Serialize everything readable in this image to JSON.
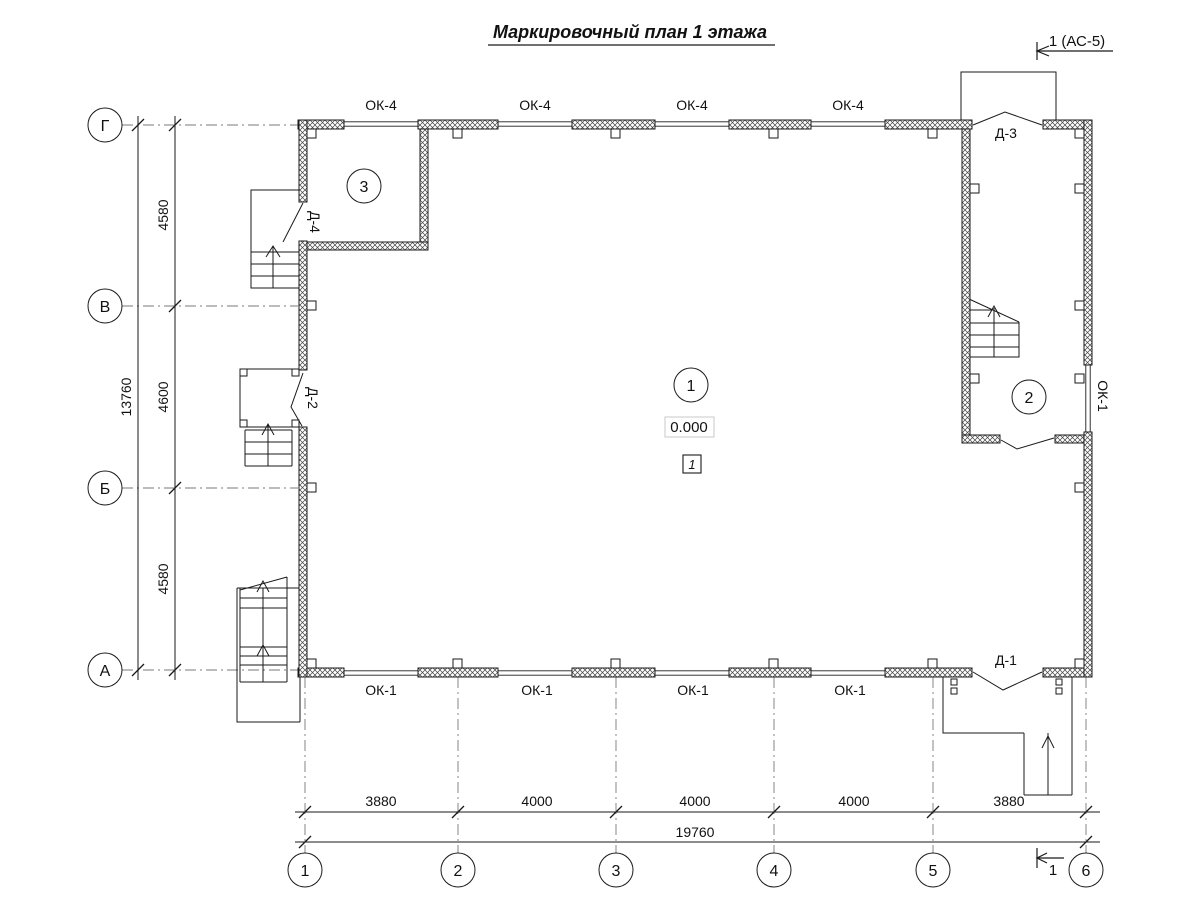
{
  "title": "Маркировочный план 1 этажа",
  "section_markers": {
    "top": "1 (АС-5)",
    "bottom": "1"
  },
  "axes": {
    "rows": [
      "Г",
      "В",
      "Б",
      "А"
    ],
    "cols": [
      "1",
      "2",
      "3",
      "4",
      "5",
      "6"
    ]
  },
  "dimensions": {
    "vertical": {
      "segments": [
        "4580",
        "4600",
        "4580"
      ],
      "total": "13760"
    },
    "horizontal": {
      "segments": [
        "3880",
        "4000",
        "4000",
        "4000",
        "3880"
      ],
      "total": "19760"
    }
  },
  "windows": {
    "top": [
      "ОК-4",
      "ОК-4",
      "ОК-4",
      "ОК-4"
    ],
    "bottom": [
      "ОК-1",
      "ОК-1",
      "ОК-1",
      "ОК-1"
    ],
    "right": "ОК-1"
  },
  "doors": {
    "d1": "Д-1",
    "d2": "Д-2",
    "d3": "Д-3",
    "d4": "Д-4"
  },
  "rooms": [
    "1",
    "2",
    "3"
  ],
  "elevation": "0.000",
  "floor_type_mark": "1",
  "colors": {
    "line": "#1a1a1a",
    "axis_line": "#7a7a7a",
    "hatch": "#444444",
    "elevation_box_border": "#c8c8c8"
  }
}
